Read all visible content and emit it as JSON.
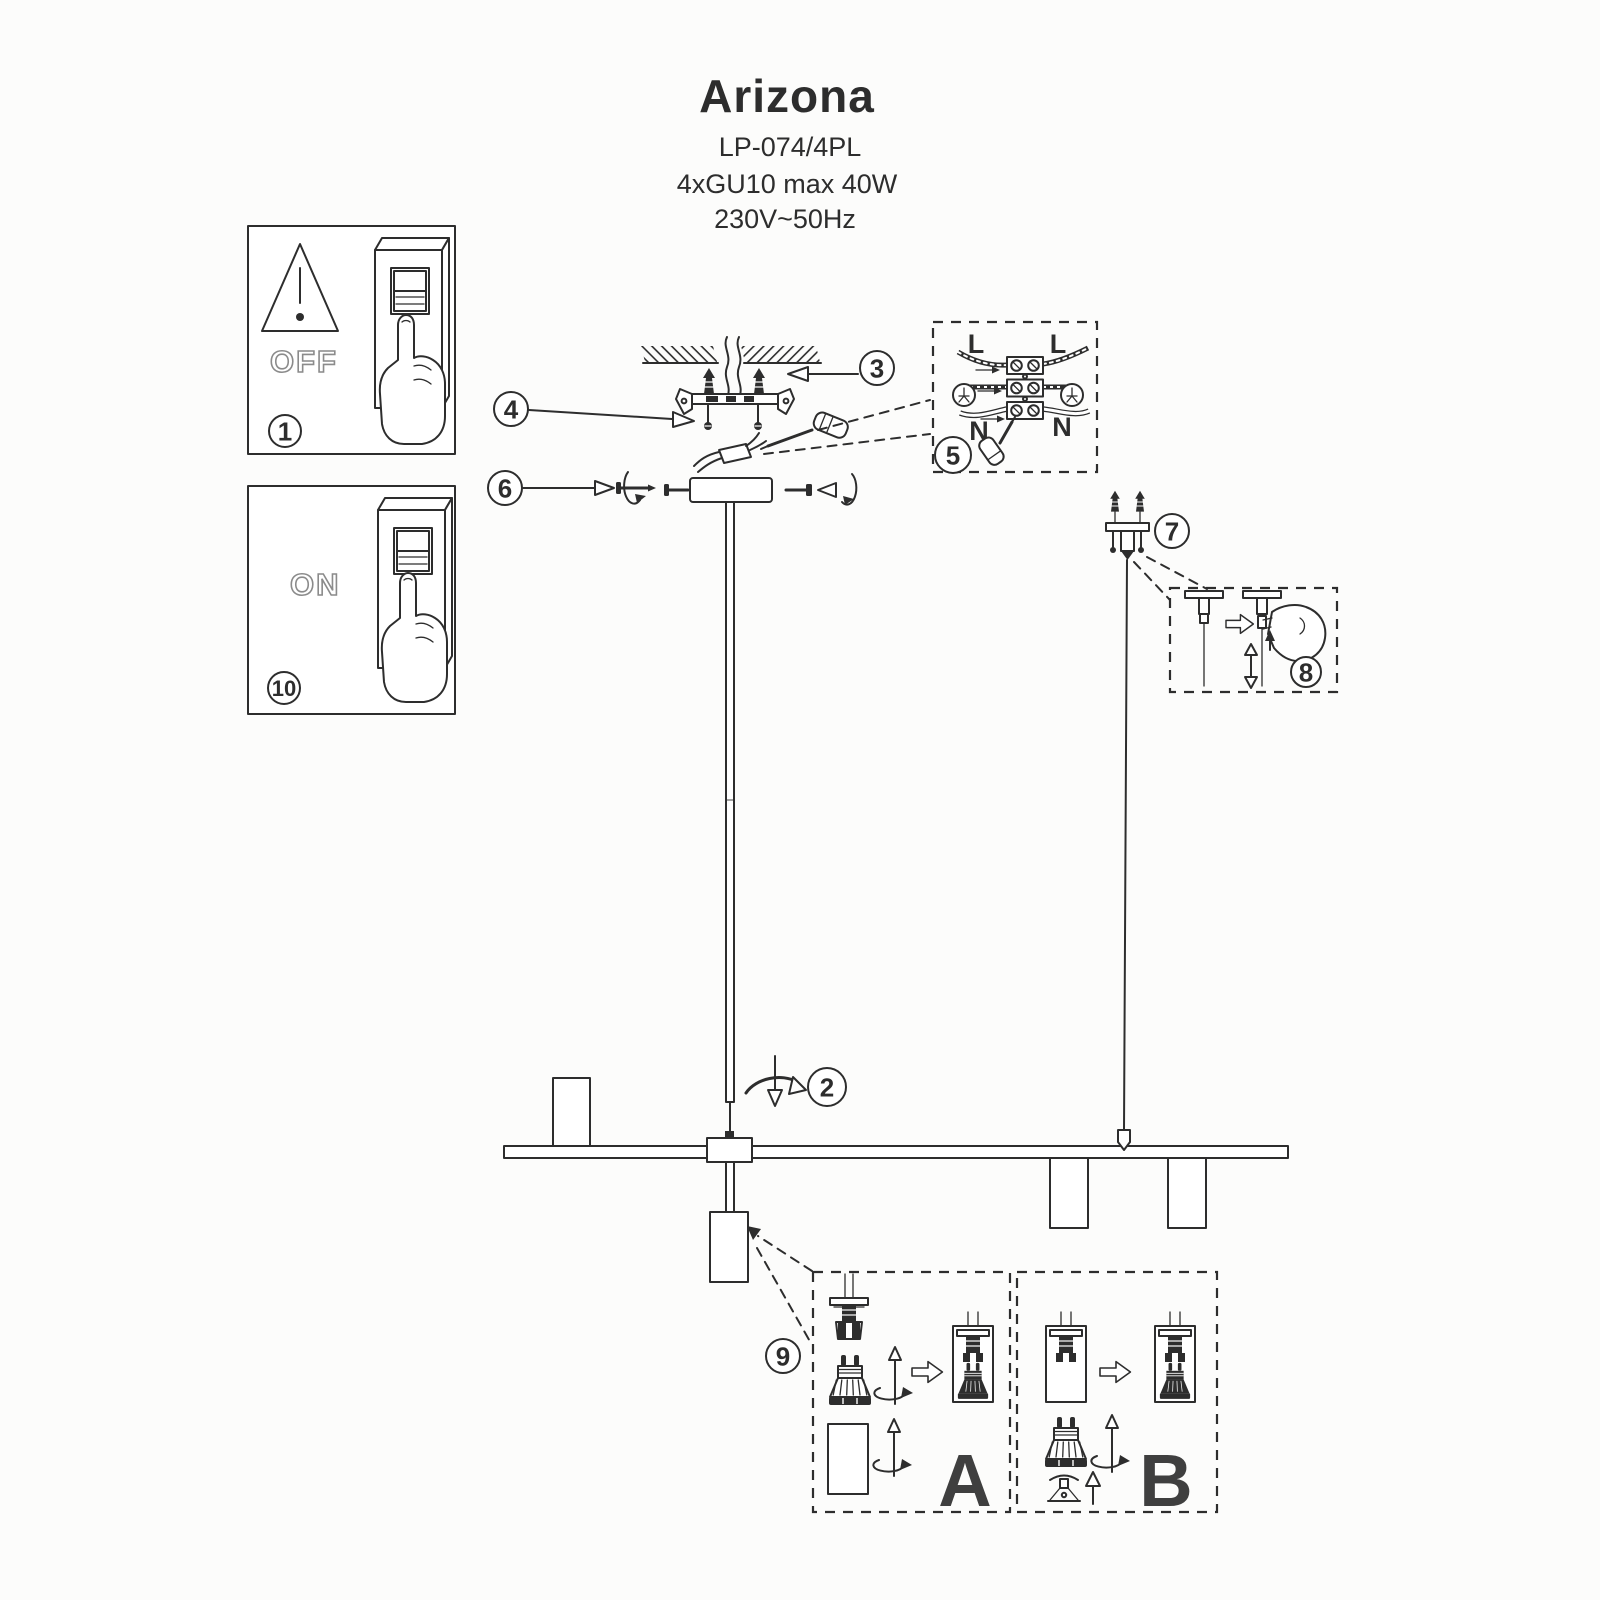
{
  "title_block": {
    "product_name": "Arizona",
    "model": "LP-074/4PL",
    "bulb_spec": "4xGU10 max 40W",
    "voltage_spec": "230V~50Hz"
  },
  "switch_boxes": {
    "off_label": "OFF",
    "on_label": "ON"
  },
  "step_numbers": {
    "step1": "1",
    "step2": "2",
    "step3": "3",
    "step4": "4",
    "step5": "5",
    "step6": "6",
    "step7": "7",
    "step8": "8",
    "step9": "9",
    "step10": "10"
  },
  "wiring_diagram": {
    "live_left": "L",
    "live_right": "L",
    "neutral_left": "N",
    "neutral_right": "N"
  },
  "bulb_variants": {
    "variant_a": "A",
    "variant_b": "B"
  },
  "icons": [
    "warning-triangle-icon",
    "finger-press-switch-icon",
    "ceiling-hatch-icon",
    "wall-plug-icon",
    "screwdriver-icon",
    "terminal-block-icon",
    "earth-ground-icon",
    "rotation-arrow-icon",
    "block-arrow-icon",
    "gu10-bulb-icon",
    "lamp-shade-icon",
    "cable-hanger-icon",
    "pinch-hand-icon"
  ],
  "colors": {
    "ink": "#2d2d2d",
    "paper": "#fcfcfb",
    "letter_gray": "#3f3f3f",
    "outline_text": "#8b8b8b"
  }
}
